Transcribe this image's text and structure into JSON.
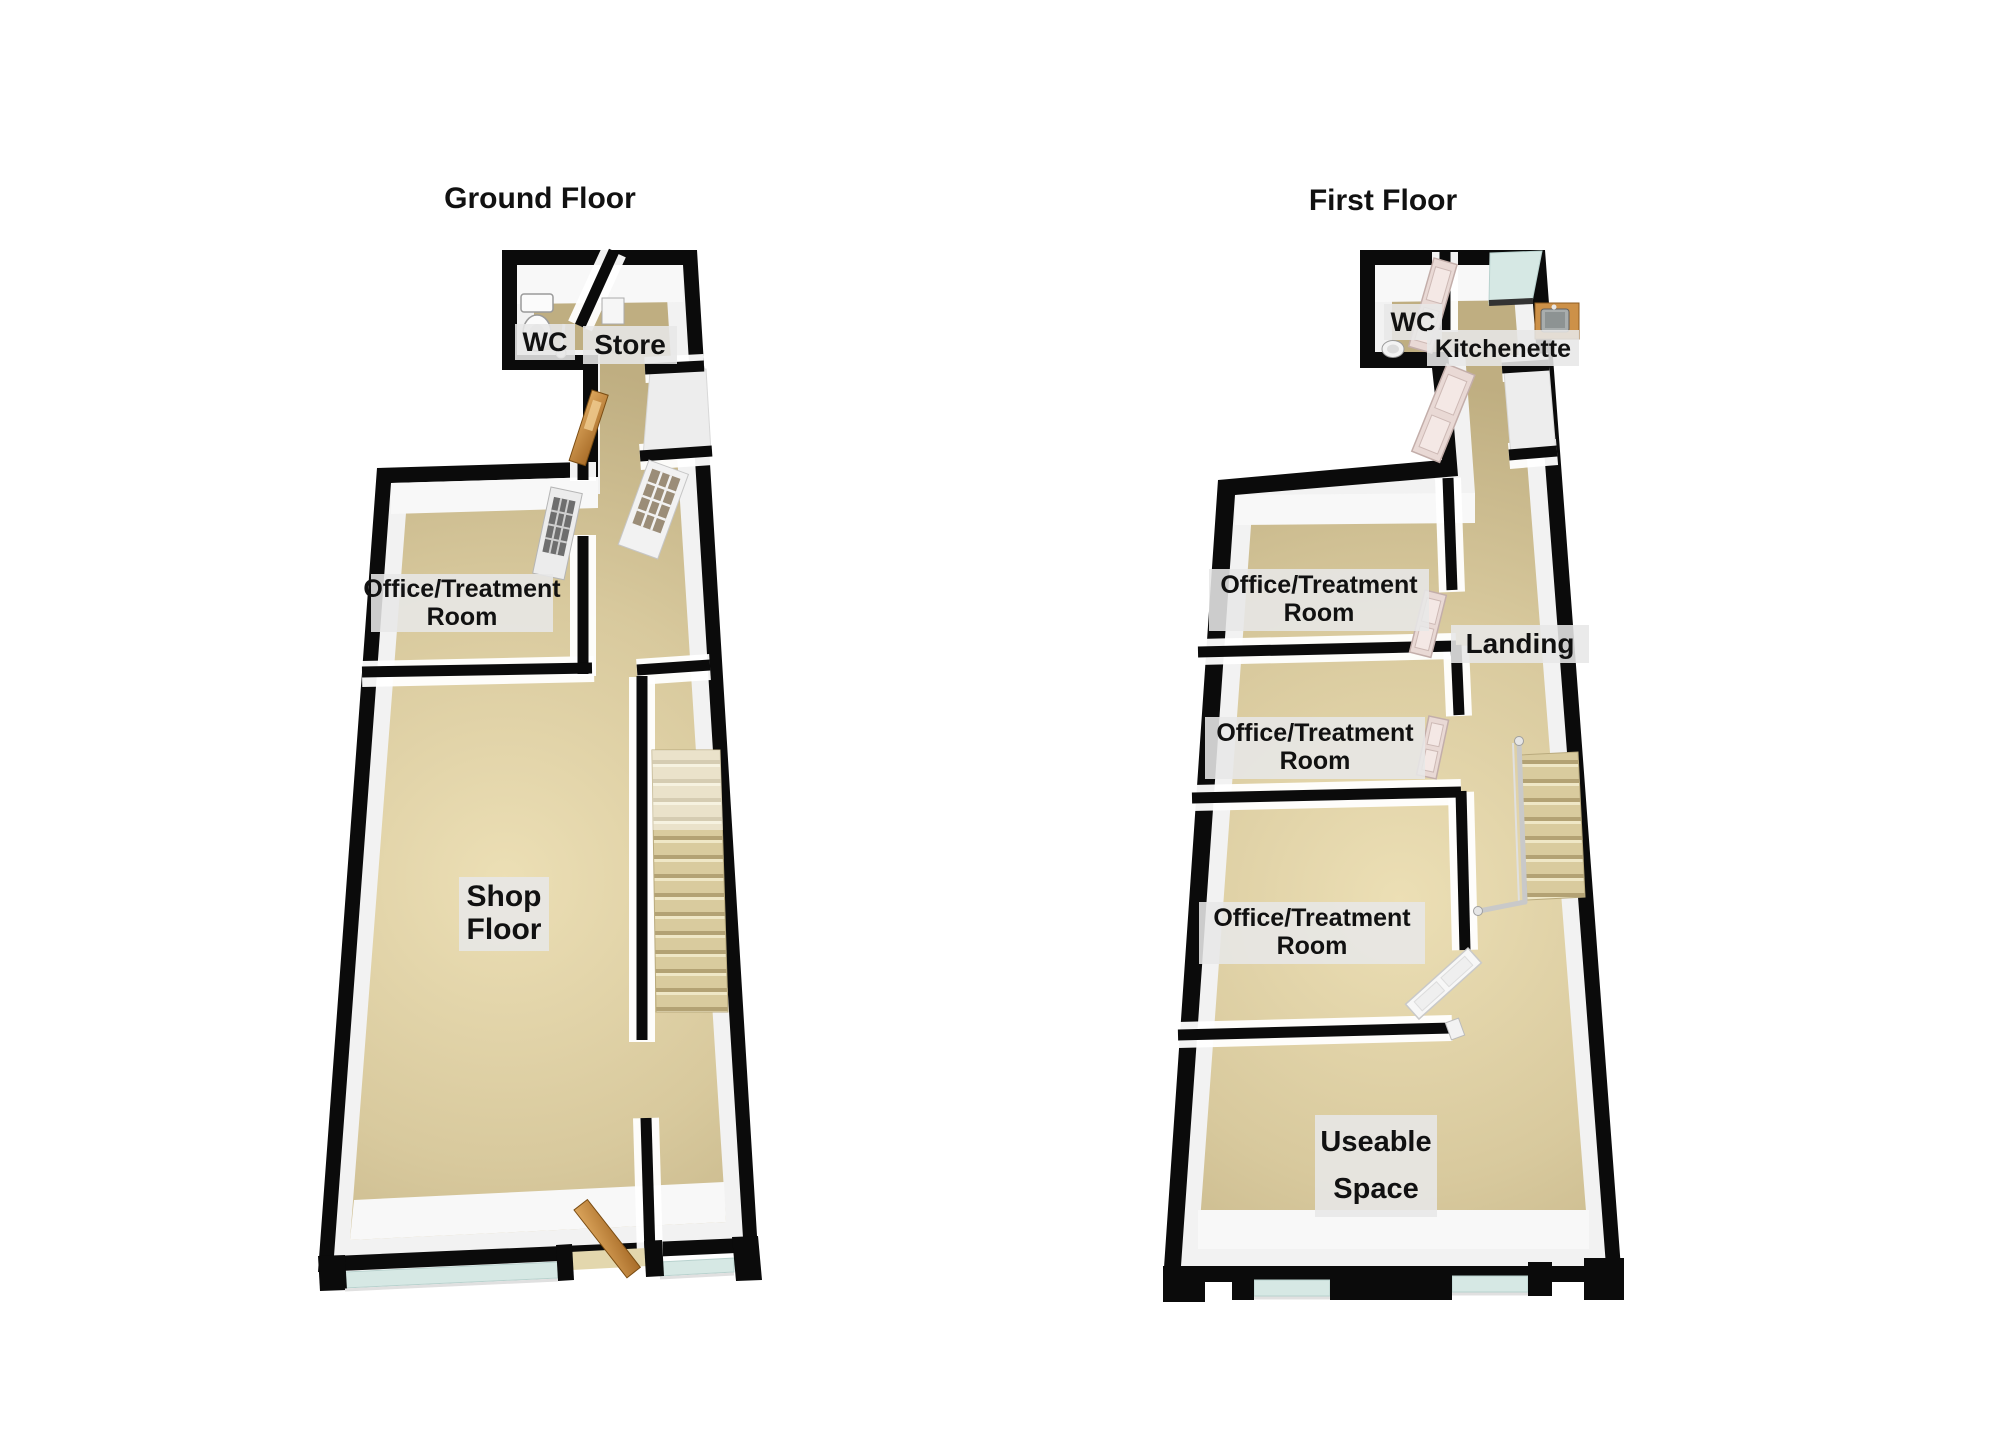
{
  "page": {
    "background": "#ffffff"
  },
  "colors": {
    "wall": "#0b0b0b",
    "wall_face": "#f2f2f2",
    "floor_light": "#ecdfb5",
    "floor_mid": "#d8c99d",
    "floor_dark": "#bfae81",
    "glass": "#d6e8e4",
    "wood": "#cd9148",
    "wood_dark": "#8f5c20",
    "door_pink": "#e9d9d5",
    "label_bg": "#e7e7e7",
    "text": "#111111",
    "rail": "#c9c9c9"
  },
  "ground_floor": {
    "title": "Ground Floor",
    "labels": {
      "wc": "WC",
      "store": "Store",
      "office_line1": "Office/Treatment",
      "office_line2": "Room",
      "shop_line1": "Shop",
      "shop_line2": "Floor"
    }
  },
  "first_floor": {
    "title": "First Floor",
    "labels": {
      "wc": "WC",
      "kitchenette": "Kitchenette",
      "office1_line1": "Office/Treatment",
      "office1_line2": "Room",
      "landing": "Landing",
      "office2_line1": "Office/Treatment",
      "office2_line2": "Room",
      "office3_line1": "Office/Treatment",
      "office3_line2": "Room",
      "useable_line1": "Useable",
      "useable_line2": "Space"
    }
  }
}
